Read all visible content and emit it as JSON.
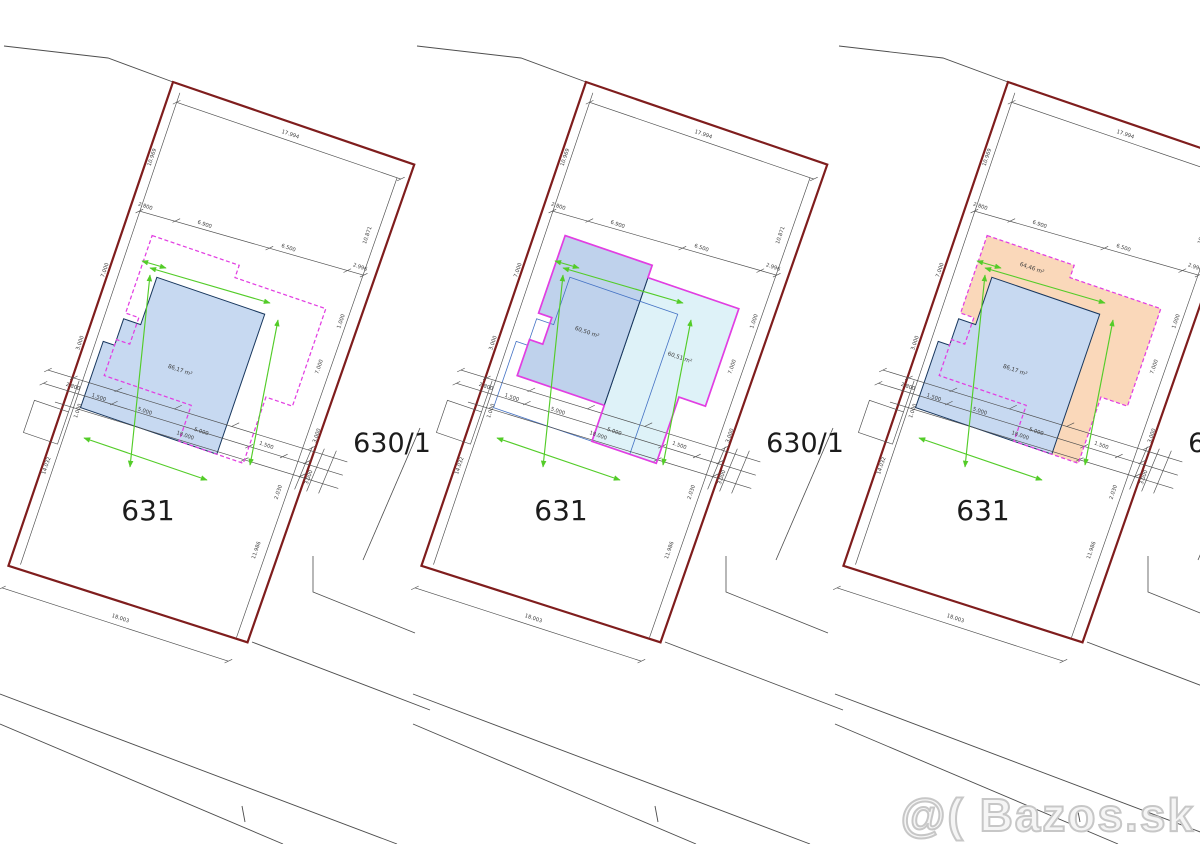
{
  "watermark": "@( Bazos.sk",
  "parcel_labels": {
    "main": "631",
    "neighbor": "630/1"
  },
  "colors": {
    "plot_border": "#7f1d1d",
    "thin_line": "#4d4d4d",
    "dim_text": "#3c3c3c",
    "magenta": "#e23ee2",
    "green": "#53cc28",
    "blue_fill": "#c7d9f1",
    "blue_stroke": "#17365d",
    "blue2_fill": "#bfd2ec",
    "cyan_fill": "#def2f8",
    "orange_fill": "#fad8ba",
    "ghost_stroke": "#4472c4",
    "parcel_text": "#1c1c1c"
  },
  "dim_labels": [
    {
      "t": "17.994",
      "x": 128,
      "y": 13,
      "r": 0
    },
    {
      "t": "10.969",
      "x": 6,
      "y": 78,
      "r": -90
    },
    {
      "t": "14.032",
      "x": 6,
      "y": 404,
      "r": -90
    },
    {
      "t": "10.871",
      "x": 235,
      "y": 82,
      "r": -90
    },
    {
      "t": "11.986",
      "x": 232,
      "y": 416,
      "r": -90
    },
    {
      "t": "18.003",
      "x": 124,
      "y": 526,
      "r": 0
    },
    {
      "t": "2.800",
      "x": 14,
      "y": 128,
      "r": 0
    },
    {
      "t": "6.900",
      "x": 76,
      "y": 126,
      "r": 0
    },
    {
      "t": "6.500",
      "x": 163,
      "y": 121,
      "r": 0
    },
    {
      "t": "2.996",
      "x": 237,
      "y": 116,
      "r": 0
    },
    {
      "t": "7.000",
      "x": -2,
      "y": 200,
      "r": -90
    },
    {
      "t": "3.000",
      "x": -2,
      "y": 277,
      "r": -90
    },
    {
      "t": "1.000",
      "x": 238,
      "y": 172,
      "r": -90
    },
    {
      "t": "7.000",
      "x": 232,
      "y": 222,
      "r": -90
    },
    {
      "t": "3.000",
      "x": 252,
      "y": 288,
      "r": -90
    },
    {
      "t": "3.000",
      "x": 258,
      "y": 330,
      "r": -90
    },
    {
      "t": "2.030",
      "x": 234,
      "y": 354,
      "r": -90
    },
    {
      "t": "1.500",
      "x": 206,
      "y": 315,
      "r": 0
    },
    {
      "t": "2.800",
      "x": 4,
      "y": 322,
      "r": 0
    },
    {
      "t": "1.500",
      "x": 32,
      "y": 324,
      "r": 0
    },
    {
      "t": "1.000",
      "x": 18,
      "y": 342,
      "r": -90
    },
    {
      "t": "5.000",
      "x": 80,
      "y": 322,
      "r": 0
    },
    {
      "t": "5.000",
      "x": 140,
      "y": 323,
      "r": 0
    },
    {
      "t": "18.000",
      "x": 126,
      "y": 332,
      "r": 0
    }
  ],
  "panels": [
    {
      "variant": "existing-house",
      "outline_style": "dashed",
      "area_labels": [
        {
          "t": "86,17 m²",
          "x": 100,
          "y": 272
        }
      ],
      "shapes": [
        {
          "path": "house86",
          "fill": "blue_fill",
          "stroke": "blue_stroke",
          "name": "existing-house-footprint"
        }
      ]
    },
    {
      "variant": "proposal-two-volumes",
      "outline_style": "solid",
      "area_labels": [
        {
          "t": "60,50 m²",
          "x": 82,
          "y": 238
        },
        {
          "t": "60,51 m²",
          "x": 178,
          "y": 232
        }
      ],
      "shapes": [
        {
          "path": "house60b",
          "fill": "cyan_fill",
          "stroke": "blue_stroke",
          "name": "proposed-volume-b-footprint"
        },
        {
          "path": "house60a",
          "fill": "blue2_fill",
          "stroke": "blue_stroke",
          "name": "proposed-volume-a-footprint"
        },
        {
          "path": "house86",
          "fill": "none",
          "stroke": "ghost_stroke",
          "name": "existing-house-ghost-outline"
        }
      ]
    },
    {
      "variant": "proposal-overlay",
      "outline_style": "dashed",
      "area_labels": [
        {
          "t": "64,46 m²",
          "x": 83,
          "y": 170
        },
        {
          "t": "86,17 m²",
          "x": 100,
          "y": 272
        }
      ],
      "shapes": [
        {
          "path": "union",
          "fill": "orange_fill",
          "stroke": "none",
          "name": "proposed-footprint-fill"
        },
        {
          "path": "house86",
          "fill": "blue_fill",
          "stroke": "blue_stroke",
          "name": "existing-house-footprint"
        }
      ]
    }
  ]
}
